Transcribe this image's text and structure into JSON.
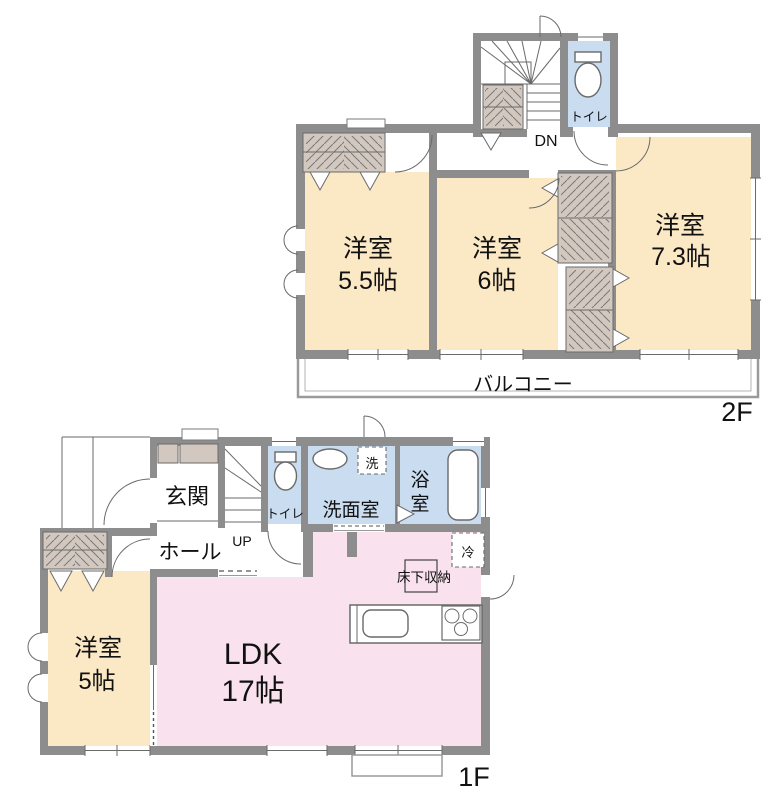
{
  "palette": {
    "wall": "#8d8d8d",
    "thin": "#9a9a9a",
    "line": "#6a6a6a",
    "text": "#111111",
    "cream": "#fbe9c6",
    "pink": "#f9e2ee",
    "blue": "#c9dcf0",
    "beige": "#d2c8bf",
    "bg": "#ffffff"
  },
  "floor_2f": {
    "floor_label": "2F",
    "stairs_label": "DN",
    "balcony_label": "バルコニー",
    "toilet_label": "トイレ",
    "bedroom_a": {
      "type": "洋室",
      "size": "5.5帖"
    },
    "bedroom_b": {
      "type": "洋室",
      "size": "6帖"
    },
    "bedroom_c": {
      "type": "洋室",
      "size": "7.3帖"
    }
  },
  "floor_1f": {
    "floor_label": "1F",
    "stairs_label": "UP",
    "entrance_label": "玄関",
    "hall_label": "ホール",
    "toilet_label": "トイレ",
    "washroom_label": "洗面室",
    "washer_label": "洗",
    "bathroom_label_line1": "浴",
    "bathroom_label_line2": "室",
    "fridge_label": "冷",
    "underfloor_storage_label": "床下収納",
    "ldk": {
      "type": "LDK",
      "size": "17帖"
    },
    "bedroom_d": {
      "type": "洋室",
      "size": "5帖"
    }
  }
}
